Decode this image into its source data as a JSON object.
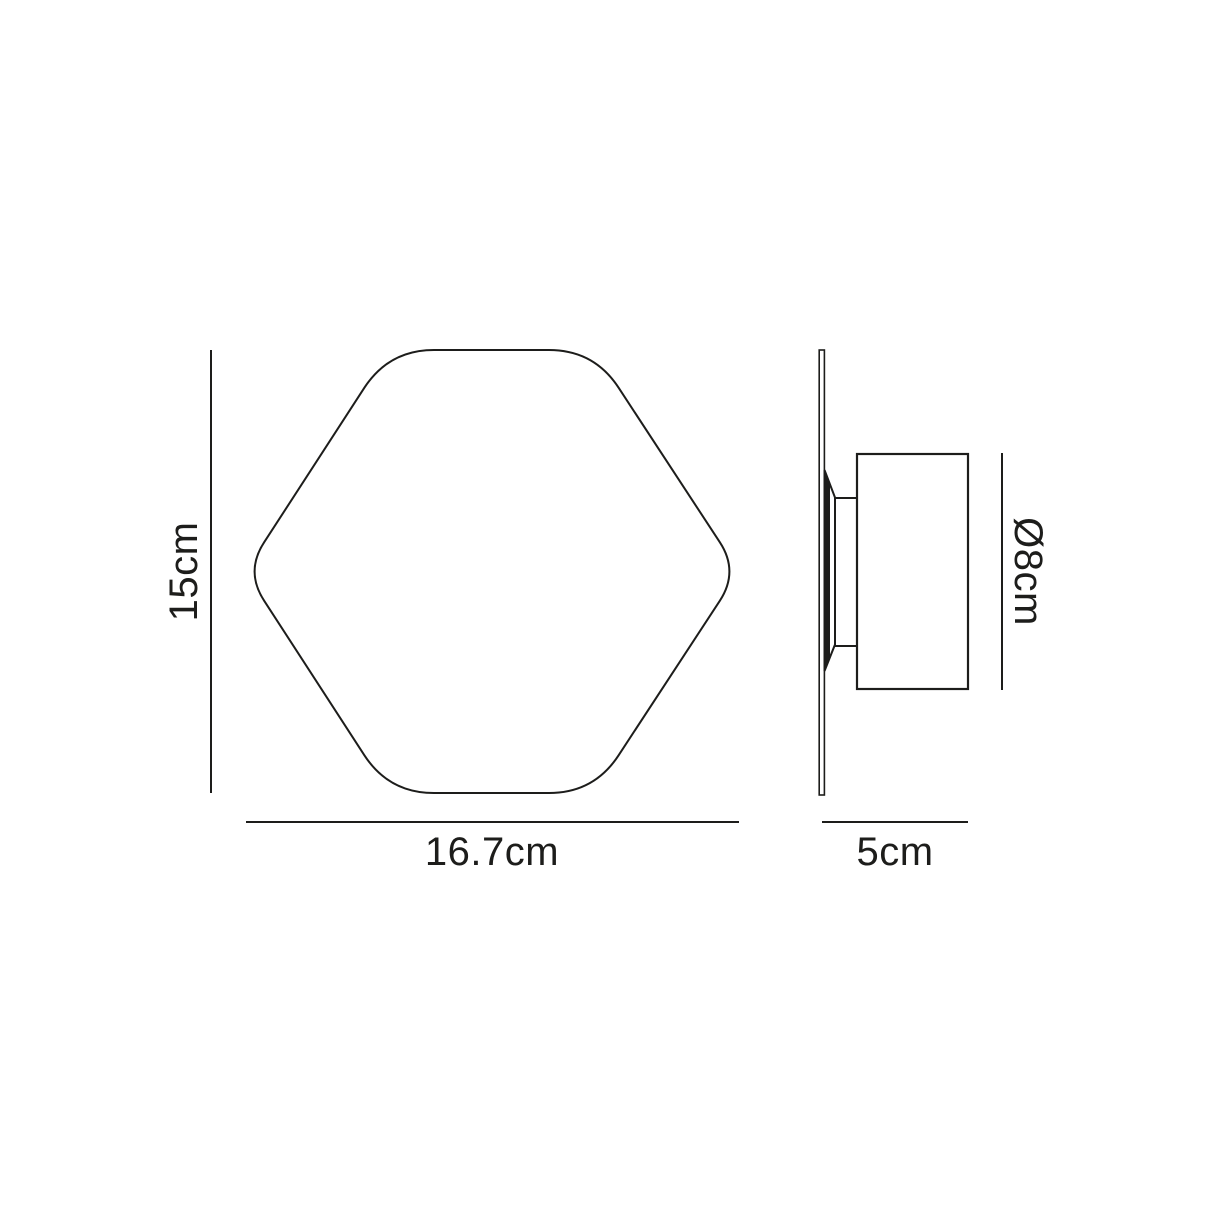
{
  "front_view": {
    "height_label": "15cm",
    "width_label": "16.7cm"
  },
  "side_view": {
    "diameter_label": "Ø8cm",
    "depth_label": "5cm"
  },
  "colors": {
    "line": "#1d1d1b",
    "text": "#1d1d1b",
    "background": "#ffffff"
  }
}
